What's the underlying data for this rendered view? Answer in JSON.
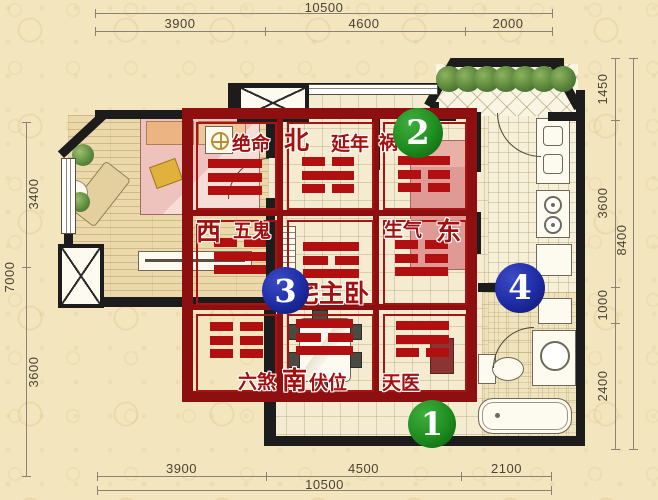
{
  "dimensions": {
    "top": {
      "total": "10500",
      "segments": [
        "3900",
        "4600",
        "2000"
      ]
    },
    "bottom": {
      "total": "10500",
      "segments": [
        "3900",
        "4500",
        "2100"
      ]
    },
    "left": {
      "total": "7000",
      "segments": [
        "3400",
        "3600"
      ]
    },
    "right": {
      "total": "8400",
      "segments": [
        "1450",
        "3600",
        "1000",
        "2400"
      ]
    }
  },
  "bagua": {
    "nw": {
      "star": "绝命",
      "trigram": [
        "solid",
        "solid",
        "solid"
      ],
      "trigram_name": "qian-heaven"
    },
    "n": {
      "direction": "北",
      "star": "延年",
      "trigram": [
        "broken",
        "solid",
        "broken"
      ],
      "trigram_name": "kan-water"
    },
    "ne": {
      "star": "祸",
      "trigram": [
        "solid",
        "broken",
        "broken"
      ],
      "trigram_name": "gen-mountain"
    },
    "w": {
      "direction": "西",
      "star": "五鬼",
      "trigram": [
        "broken",
        "solid",
        "solid"
      ],
      "trigram_name": "dui-lake"
    },
    "center": {
      "label": "宅主卧",
      "trigram": [
        "solid",
        "broken",
        "solid"
      ],
      "trigram_name": "li-fire"
    },
    "e": {
      "star": "生气",
      "direction": "东",
      "trigram": [
        "broken",
        "broken",
        "solid"
      ],
      "trigram_name": "zhen-thunder"
    },
    "sw": {
      "star": "六煞",
      "trigram": [
        "broken",
        "broken",
        "broken"
      ],
      "trigram_name": "kun-earth"
    },
    "s": {
      "direction": "南",
      "star": "伏位",
      "trigram": [
        "solid",
        "broken",
        "solid"
      ],
      "trigram_name": "li-fire"
    },
    "se": {
      "star": "天医",
      "trigram": [
        "solid",
        "solid",
        "broken"
      ],
      "trigram_name": "xun-wind"
    }
  },
  "badges": {
    "b1": "1",
    "b2": "2",
    "b3": "3",
    "b4": "4"
  },
  "colors": {
    "grid_red": "#8d0f10",
    "cell_red": "#a81414",
    "trigram_red": "#b21010",
    "label_red": "#a40f0f",
    "badge_green": "#1e8c1e",
    "badge_blue": "#1d2ba5",
    "wall": "#1c1c1c",
    "paper": "#f3e5bd"
  }
}
